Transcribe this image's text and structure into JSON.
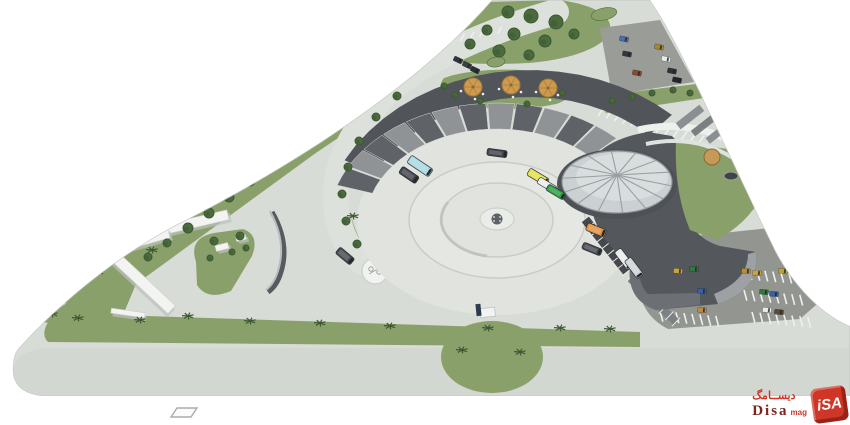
{
  "title": "bus-terminal-site-plan-3d-rendering",
  "palette": {
    "pavement": "#d8dcd6",
    "pavement_light": "#e0e3de",
    "ring_fill": "#e4e7e2",
    "ring_line": "#c9cdc8",
    "road_band": "#d2d7d1",
    "road_light": "#dde1db",
    "grass": "#8aa06b",
    "tree": "#4a6b3e",
    "tree_dark": "#3c5832",
    "palm": "#3d5a33",
    "asphalt": "#9a9c98",
    "asphalt2": "#939591",
    "roof_dark": "#54585c",
    "roof_mid": "#6c7074",
    "roof_light": "#9da1a4",
    "panel_light": "#8f9396",
    "panel_dark": "#5f6367",
    "band": "#51555a",
    "dome": "#cbd0d2",
    "dome_hi": "#dbdfe0",
    "dome_rib": "#999fa3",
    "dome_edge": "#8e959a",
    "white_struct": "#f3f4f2",
    "struct_shadow": "#bcc1bc",
    "wall": "#575b5f",
    "curb": "#c6cbc6",
    "line_white": "#eef0ed",
    "logo_red": "#cf3628",
    "logo_maroon": "#7d2420"
  },
  "watermark": {
    "arabic": "ديســامگ",
    "name": "Disa",
    "suffix": "mag",
    "cube_text": "iSA"
  },
  "scene": {
    "islands": [
      {
        "x": 604,
        "y": 14,
        "rx": 13,
        "ry": 6,
        "a": -12
      },
      {
        "x": 496,
        "y": 62,
        "rx": 9,
        "ry": 5,
        "a": -8
      },
      {
        "x": 434,
        "y": 114,
        "rx": 9,
        "ry": 5,
        "a": -10
      }
    ],
    "white_bars": [
      {
        "x": 188,
        "y": 224,
        "len": 82,
        "w": 10,
        "a": -13
      },
      {
        "x": 158,
        "y": 214,
        "len": 42,
        "w": 8,
        "a": -13
      },
      {
        "x": 142,
        "y": 241,
        "len": 56,
        "w": 9,
        "a": -16
      },
      {
        "x": 141,
        "y": 281,
        "len": 84,
        "w": 11,
        "a": 43
      },
      {
        "x": 128,
        "y": 313,
        "len": 34,
        "w": 5,
        "a": 8
      },
      {
        "x": 222,
        "y": 247,
        "len": 13,
        "w": 6,
        "a": -14
      },
      {
        "x": 241,
        "y": 238,
        "len": 10,
        "w": 5,
        "a": -14
      }
    ],
    "gray_bars": [
      {
        "x": 690,
        "y": 117,
        "len": 30,
        "w": 8,
        "a": -38,
        "c": "#8b8f92"
      },
      {
        "x": 704,
        "y": 125,
        "len": 28,
        "w": 7,
        "a": -38,
        "c": "#7b7f82"
      },
      {
        "x": 718,
        "y": 133,
        "len": 26,
        "w": 7,
        "a": -38,
        "c": "#8b8f92"
      }
    ],
    "trees": [
      [
        508,
        12,
        6
      ],
      [
        531,
        16,
        7
      ],
      [
        556,
        22,
        7
      ],
      [
        487,
        30,
        5
      ],
      [
        514,
        34,
        6
      ],
      [
        545,
        41,
        6
      ],
      [
        574,
        34,
        5
      ],
      [
        499,
        51,
        6
      ],
      [
        529,
        55,
        5
      ],
      [
        470,
        44,
        5
      ],
      [
        389,
        80,
        5
      ],
      [
        362,
        98,
        5
      ],
      [
        338,
        116,
        5
      ],
      [
        313,
        133,
        5
      ],
      [
        292,
        149,
        5
      ],
      [
        271,
        165,
        5
      ],
      [
        250,
        181,
        5
      ],
      [
        229,
        197,
        5
      ],
      [
        209,
        213,
        5
      ],
      [
        188,
        228,
        5
      ],
      [
        167,
        243,
        4
      ],
      [
        148,
        257,
        4
      ],
      [
        397,
        96,
        4
      ],
      [
        376,
        117,
        4
      ],
      [
        359,
        141,
        4
      ],
      [
        348,
        167,
        4
      ],
      [
        342,
        194,
        4
      ],
      [
        346,
        221,
        4
      ],
      [
        357,
        244,
        4
      ],
      [
        214,
        241,
        4
      ],
      [
        240,
        236,
        4
      ],
      [
        232,
        252,
        3
      ],
      [
        210,
        258,
        3
      ],
      [
        246,
        248,
        3
      ],
      [
        455,
        95,
        3
      ],
      [
        480,
        101,
        3
      ],
      [
        527,
        104,
        3
      ],
      [
        562,
        93,
        3
      ],
      [
        444,
        86,
        3
      ],
      [
        612,
        101,
        3
      ],
      [
        632,
        97,
        3
      ],
      [
        652,
        93,
        3
      ],
      [
        673,
        90,
        3
      ],
      [
        690,
        93,
        3
      ]
    ],
    "tan_tree": {
      "x": 712,
      "y": 157,
      "r": 8,
      "color": "#c49a56",
      "edge": "#8a6a34"
    },
    "pond": {
      "x": 731,
      "y": 176,
      "rx": 7,
      "ry": 4
    },
    "palms": [
      [
        52,
        314
      ],
      [
        78,
        318
      ],
      [
        140,
        320
      ],
      [
        188,
        316
      ],
      [
        250,
        321
      ],
      [
        320,
        323
      ],
      [
        390,
        326
      ],
      [
        560,
        328
      ],
      [
        610,
        329
      ],
      [
        152,
        250
      ],
      [
        98,
        272
      ],
      [
        353,
        216
      ],
      [
        488,
        328
      ],
      [
        462,
        350
      ],
      [
        520,
        352
      ]
    ],
    "parasols": [
      [
        473,
        87
      ],
      [
        511,
        85
      ],
      [
        548,
        88
      ]
    ],
    "buses": [
      [
        420,
        166,
        34,
        26,
        9,
        "#a8d8e0"
      ],
      [
        409,
        175,
        34,
        20,
        8,
        "#41464e"
      ],
      [
        497,
        153,
        8,
        20,
        7,
        "#3f444b"
      ],
      [
        538,
        177,
        31,
        22,
        8,
        "#e3e04c"
      ],
      [
        547,
        185,
        31,
        20,
        7,
        "#eceeee"
      ],
      [
        556,
        192,
        31,
        20,
        7,
        "#2f9e44"
      ],
      [
        596,
        230,
        22,
        20,
        8,
        "#e09140"
      ],
      [
        592,
        249,
        22,
        20,
        7,
        "#494e54"
      ],
      [
        624,
        259,
        53,
        22,
        8,
        "#e8ebea"
      ],
      [
        634,
        268,
        53,
        22,
        8,
        "#cfd3d4"
      ],
      [
        345,
        256,
        40,
        19,
        8,
        "#464b51"
      ]
    ],
    "cars": [
      [
        624,
        39,
        12,
        "#4a6fae"
      ],
      [
        627,
        54,
        12,
        "#34383d"
      ],
      [
        637,
        73,
        12,
        "#8a4a2e"
      ],
      [
        659,
        47,
        12,
        "#a8862f"
      ],
      [
        666,
        59,
        12,
        "#e9ebeb"
      ],
      [
        672,
        71,
        12,
        "#2f3338"
      ],
      [
        677,
        80,
        12,
        "#23262b"
      ],
      [
        458,
        60,
        25,
        "#33373d"
      ],
      [
        467,
        65,
        25,
        "#3b4046"
      ],
      [
        475,
        70,
        25,
        "#2c3036"
      ],
      [
        678,
        271,
        5,
        "#c9a33b"
      ],
      [
        694,
        269,
        5,
        "#2f7a3a"
      ],
      [
        702,
        291,
        5,
        "#3a5fa9"
      ],
      [
        702,
        310,
        5,
        "#c08a3b"
      ],
      [
        746,
        271,
        5,
        "#b59130"
      ],
      [
        757,
        273,
        5,
        "#c9a33b"
      ],
      [
        783,
        271,
        5,
        "#bfa23a"
      ],
      [
        764,
        292,
        5,
        "#2f7a3a"
      ],
      [
        774,
        294,
        5,
        "#3a5fa9"
      ],
      [
        767,
        310,
        5,
        "#e9ebeb"
      ],
      [
        779,
        312,
        5,
        "#5a4a3c"
      ]
    ],
    "park_lines": [
      {
        "x": 598,
        "y": 116,
        "dir": 17,
        "n": 13,
        "gap": 8.6,
        "ta": -55,
        "len": 13
      },
      {
        "x": 414,
        "y": 50,
        "dir": -11,
        "n": 10,
        "gap": 9.5,
        "ta": -62,
        "len": 8
      },
      {
        "x": 640,
        "y": 267,
        "dir": 5,
        "n": 7,
        "gap": 8,
        "ta": 75,
        "len": 11
      },
      {
        "x": 652,
        "y": 289,
        "dir": 5,
        "n": 7,
        "gap": 8,
        "ta": 75,
        "len": 11
      },
      {
        "x": 660,
        "y": 311,
        "dir": 5,
        "n": 8,
        "gap": 8,
        "ta": 75,
        "len": 11
      },
      {
        "x": 733,
        "y": 268,
        "dir": 5,
        "n": 9,
        "gap": 8,
        "ta": 75,
        "len": 11
      },
      {
        "x": 744,
        "y": 290,
        "dir": 5,
        "n": 8,
        "gap": 8,
        "ta": 75,
        "len": 11
      },
      {
        "x": 752,
        "y": 312,
        "dir": 5,
        "n": 8,
        "gap": 8,
        "ta": 75,
        "len": 11
      }
    ],
    "piers": [
      {
        "x1": 585,
        "y1": 219,
        "x2": 627,
        "y2": 272,
        "w": 9,
        "c": "#45494d",
        "ticks": 9
      },
      {
        "x1": 630,
        "y1": 278,
        "x2": 676,
        "y2": 322,
        "w": 8,
        "c": "#7c8083",
        "ticks": 8
      }
    ],
    "canopy": {
      "cx": 497,
      "cy": 222,
      "a1": 198,
      "a2": 316,
      "n": 12,
      "rxO": 168,
      "ryO": 119,
      "rxI": 131,
      "ryI": 93,
      "band": {
        "cx": 530,
        "cy": 245,
        "a1": 209,
        "a2": 312,
        "rxO": 212,
        "ryO": 175,
        "rxI": 178,
        "ryI": 148
      }
    },
    "dome": {
      "cx": 617,
      "cy": 182,
      "rx": 55,
      "ry": 31,
      "apex": 175,
      "ribs": 14
    }
  }
}
